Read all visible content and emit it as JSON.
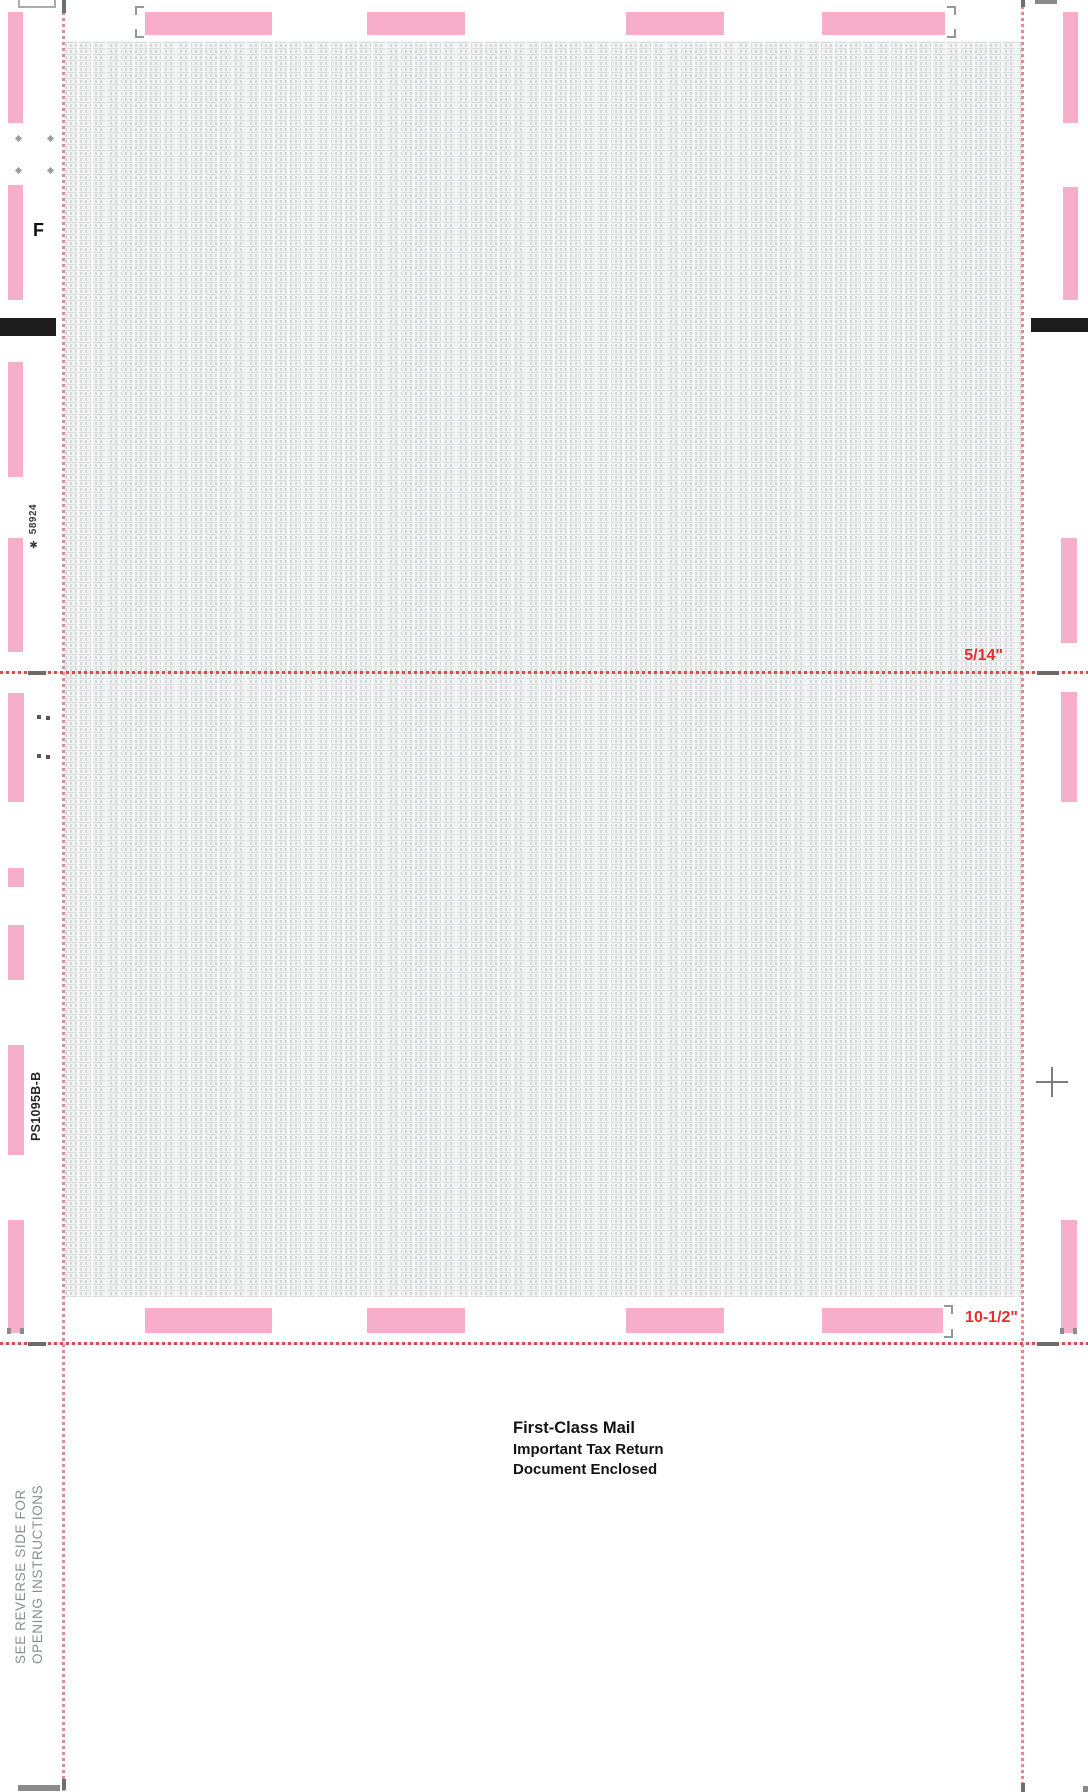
{
  "document": {
    "top_left_label": "F",
    "stock_number": "✱ 58924",
    "form_number": "PS1095B-B",
    "fold_labels": {
      "first_fold": "5/14\"",
      "second_fold": "10-1/2\""
    },
    "mailing_notice": [
      "First-Class Mail",
      "Important Tax Return",
      "Document Enclosed"
    ],
    "opening_instructions": [
      "SEE REVERSE SIDE FOR",
      "OPENING INSTRUCTIONS"
    ],
    "colors": {
      "glue_strip_pink": "#f6aecb",
      "perforation_red": "#df8c8c",
      "fold_line_red": "#cf5050",
      "fold_label_red": "#e03030",
      "pattern_ink_gray": "#d4d8da",
      "pattern_base": "#f1f2f2",
      "timing_mark_black": "#1c1c1c",
      "instruction_gray": "#8b8e91"
    }
  }
}
